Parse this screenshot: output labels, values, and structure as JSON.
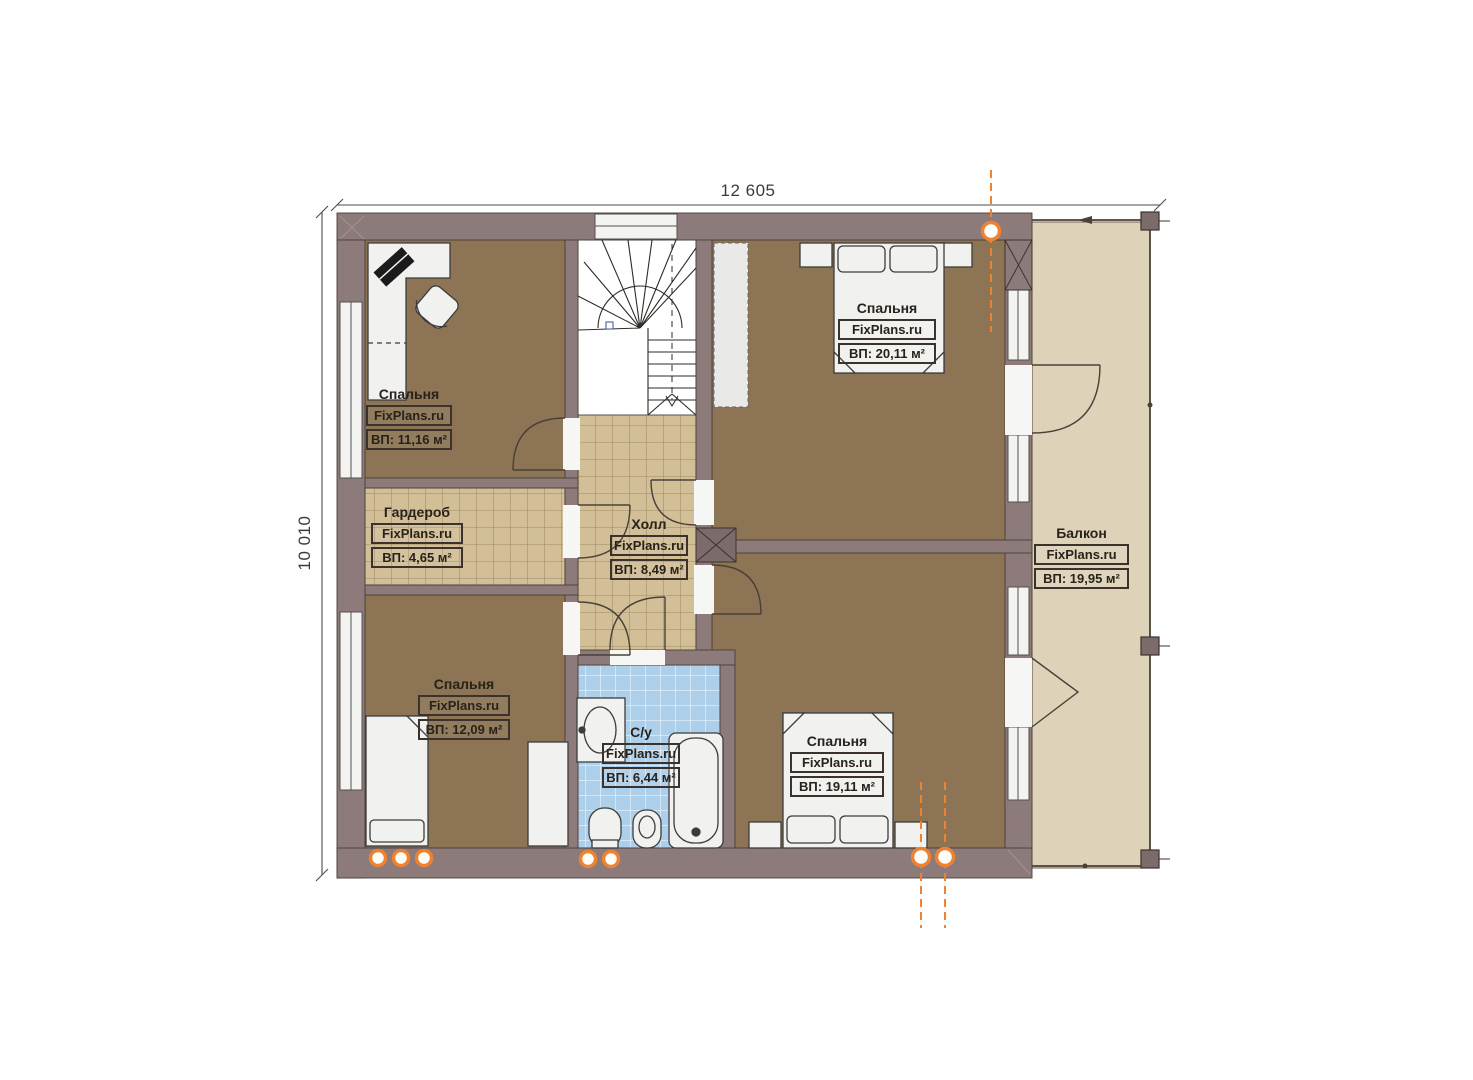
{
  "page": {
    "type": "architectural-floor-plan",
    "background": "#ffffff"
  },
  "dimensions": {
    "width": "12 605",
    "height": "10 010"
  },
  "watermark": "FixPlans.ru",
  "rooms": [
    {
      "id": "bedroom-top-left",
      "name": "Спальня",
      "brand": "FixPlans.ru",
      "area": "ВП: 11,16 м²"
    },
    {
      "id": "bedroom-top-right",
      "name": "Спальня",
      "brand": "FixPlans.ru",
      "area": "ВП: 20,11 м²"
    },
    {
      "id": "wardrobe",
      "name": "Гардероб",
      "brand": "FixPlans.ru",
      "area": "ВП: 4,65 м²"
    },
    {
      "id": "hall",
      "name": "Холл",
      "brand": "FixPlans.ru",
      "area": "ВП: 8,49 м²"
    },
    {
      "id": "bedroom-bottom-left",
      "name": "Спальня",
      "brand": "FixPlans.ru",
      "area": "ВП: 12,09 м²"
    },
    {
      "id": "bathroom",
      "name": "С/у",
      "brand": "FixPlans.ru",
      "area": "ВП: 6,44 м²"
    },
    {
      "id": "bedroom-bottom-right",
      "name": "Спальня",
      "brand": "FixPlans.ru",
      "area": "ВП: 19,11 м²"
    },
    {
      "id": "balcony",
      "name": "Балкон",
      "brand": "FixPlans.ru",
      "area": "ВП: 19,95 м²"
    }
  ],
  "icons": {
    "section_marker": "orange dashed axis marker with circle",
    "downlight": "orange ceiling light circle",
    "stairs": "u-shaped winder staircase",
    "door_arc": "door swing arc"
  },
  "colors": {
    "wall": "#8d7b7b",
    "wood_floor": "#8c7454",
    "tile_floor": "#d2bf98",
    "bath_tile": "#aecfe9",
    "balcony_floor": "#ded3b8",
    "furniture": "#f1f1ef",
    "outline": "#4a4038",
    "accent_orange": "#ef8230",
    "dimension_line": "#4b4b4b"
  }
}
